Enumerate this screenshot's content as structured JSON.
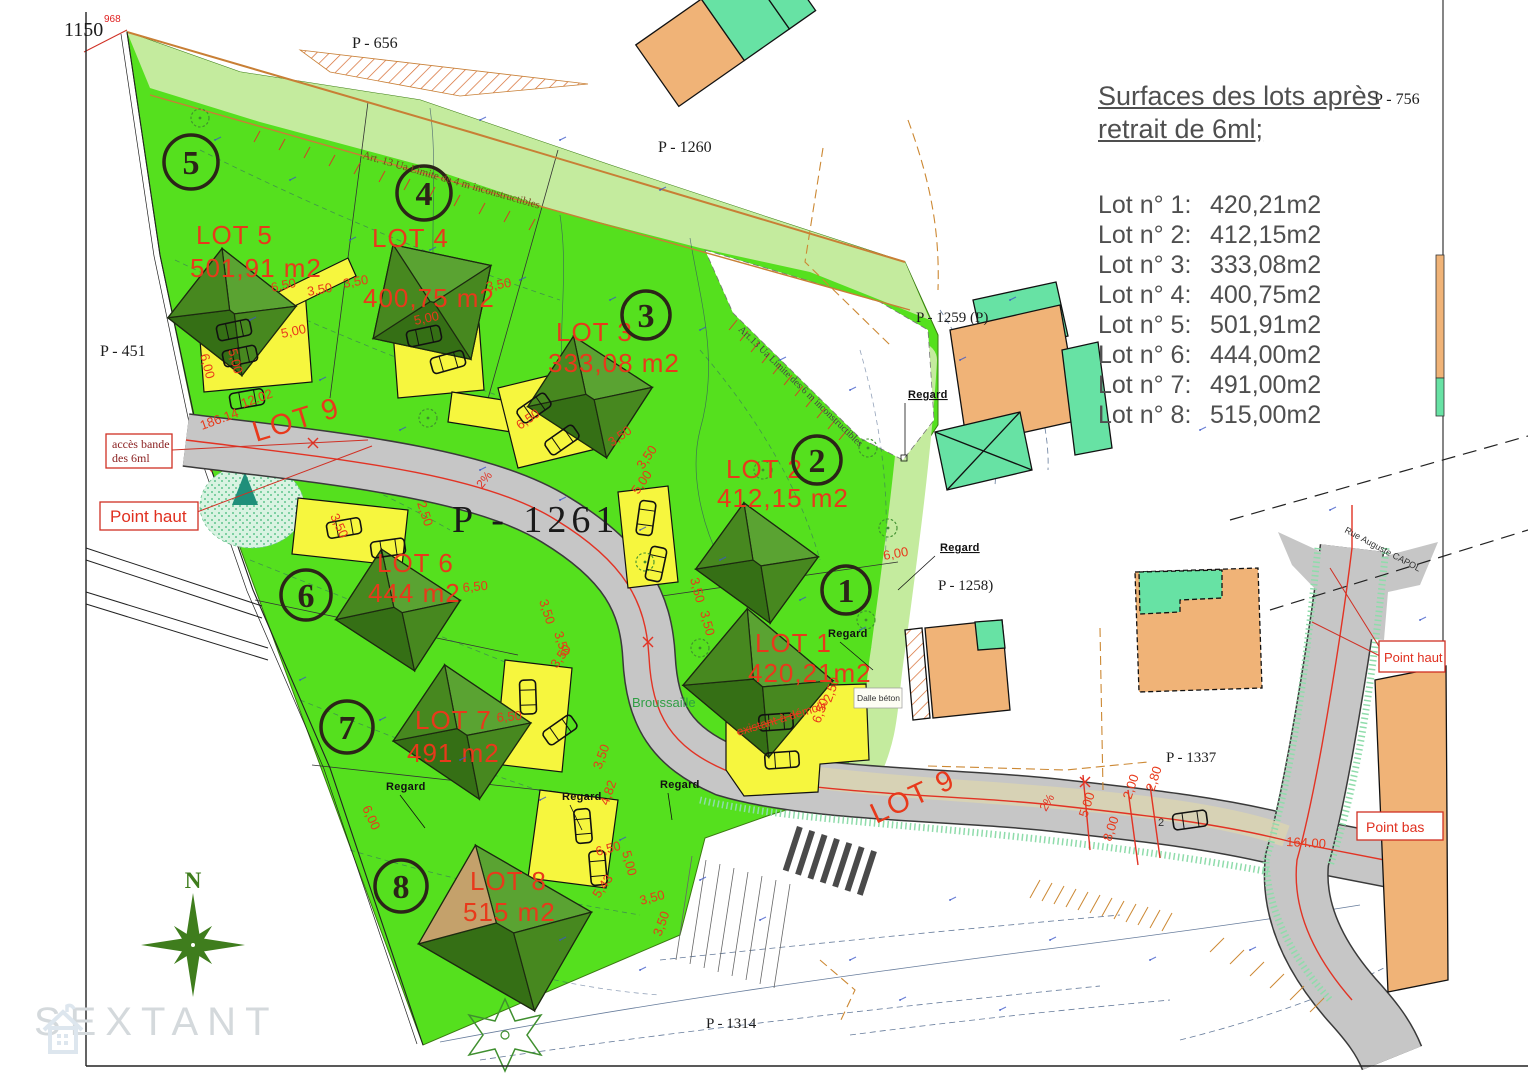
{
  "frame": {
    "coord_label": "1150",
    "benchmark_label": "968"
  },
  "legend": {
    "title_line1": "Surfaces des lots après",
    "title_line2": "retrait de 6ml;",
    "entries": [
      {
        "label": "Lot n° 1:",
        "value": "420,21m2"
      },
      {
        "label": "Lot n° 2:",
        "value": "412,15m2"
      },
      {
        "label": "Lot n° 3:",
        "value": "333,08m2"
      },
      {
        "label": "Lot n° 4:",
        "value": "400,75m2"
      },
      {
        "label": "Lot n° 5:",
        "value": "501,91m2"
      },
      {
        "label": "Lot n° 6:",
        "value": "444,00m2"
      },
      {
        "label": "Lot n° 7:",
        "value": "491,00m2"
      },
      {
        "label": "Lot n° 8:",
        "value": "515,00m2"
      }
    ]
  },
  "parcels": {
    "p451": "P - 451",
    "p656": "P - 656",
    "p756": "P - 756",
    "p1260": "P - 1260",
    "p1259": "P - 1259 (P)",
    "p1258": "P - 1258)",
    "p1261": "P - 1261",
    "p1337": "P - 1337",
    "p1314": "P - 1314"
  },
  "lots": [
    {
      "num": "1",
      "name": "LOT 1",
      "area": "420,21m2"
    },
    {
      "num": "2",
      "name": "LOT 2",
      "area": "412,15 m2"
    },
    {
      "num": "3",
      "name": "LOT 3",
      "area": "333,08 m2"
    },
    {
      "num": "4",
      "name": "LOT 4",
      "area": "400,75 m2"
    },
    {
      "num": "5",
      "name": "LOT 5",
      "area": "501,91 m2"
    },
    {
      "num": "6",
      "name": "LOT 6",
      "area": "444 m2"
    },
    {
      "num": "7",
      "name": "LOT 7",
      "area": "491 m2"
    },
    {
      "num": "8",
      "name": "LOT 8",
      "area": "515 m2"
    }
  ],
  "road": {
    "name": "LOT 9",
    "name2": "LOT 9",
    "slope_a": "2%",
    "slope_b": "2%"
  },
  "boxes": {
    "acces_line1": "accès bande",
    "acces_line2": "des 6ml",
    "point_haut_left": "Point haut",
    "point_haut_right": "Point haut",
    "point_bas": "Point bas"
  },
  "labels": {
    "regard": "Regard",
    "broussaille": "Broussaille",
    "dalle_beton": "Dalle béton",
    "demolir": "existant à démolir",
    "art13_top": "Art. 13 Ua Limite de 4 m inconstructibles",
    "art13_right": "Art.13 Ua Limite des 6 m inconstructibles",
    "street": "Rue Auguste CAPOL",
    "north": "N",
    "watermark": "SEXTANT",
    "parking_num": "2"
  },
  "dims": [
    "12.02",
    "186.14",
    "164.00",
    "6,50",
    "3,50",
    "3,50",
    "5,00",
    "5,00",
    "6,00",
    "5,00",
    "3,50",
    "6,50",
    "3,50",
    "3,50",
    "5,00",
    "3,50",
    "2,50",
    "3,50",
    "3,50",
    "6,50",
    "6,00",
    "6,50",
    "3,50",
    "3,50",
    "4,82",
    "5,43",
    "3,50",
    "3,50",
    "6,50",
    "5,00",
    "6,00",
    "3,50",
    "3,50",
    "6,50",
    "2,50",
    "5,00",
    "8,00",
    "2,00",
    "2,80"
  ],
  "colors": {
    "green_bright": "#55e01e",
    "green_light": "#c4eb9e",
    "yellow": "#f6f63e",
    "road_gray": "#c6c6c6",
    "road_beige": "#d8d3b2",
    "roof_dark": "#356f15",
    "roof_light": "#5aa332",
    "orange_building": "#f0b377",
    "teal_building": "#67e2a4",
    "red_label": "#e8391b",
    "orange_line": "#c87f35",
    "contour_blue": "#2c4a78"
  }
}
